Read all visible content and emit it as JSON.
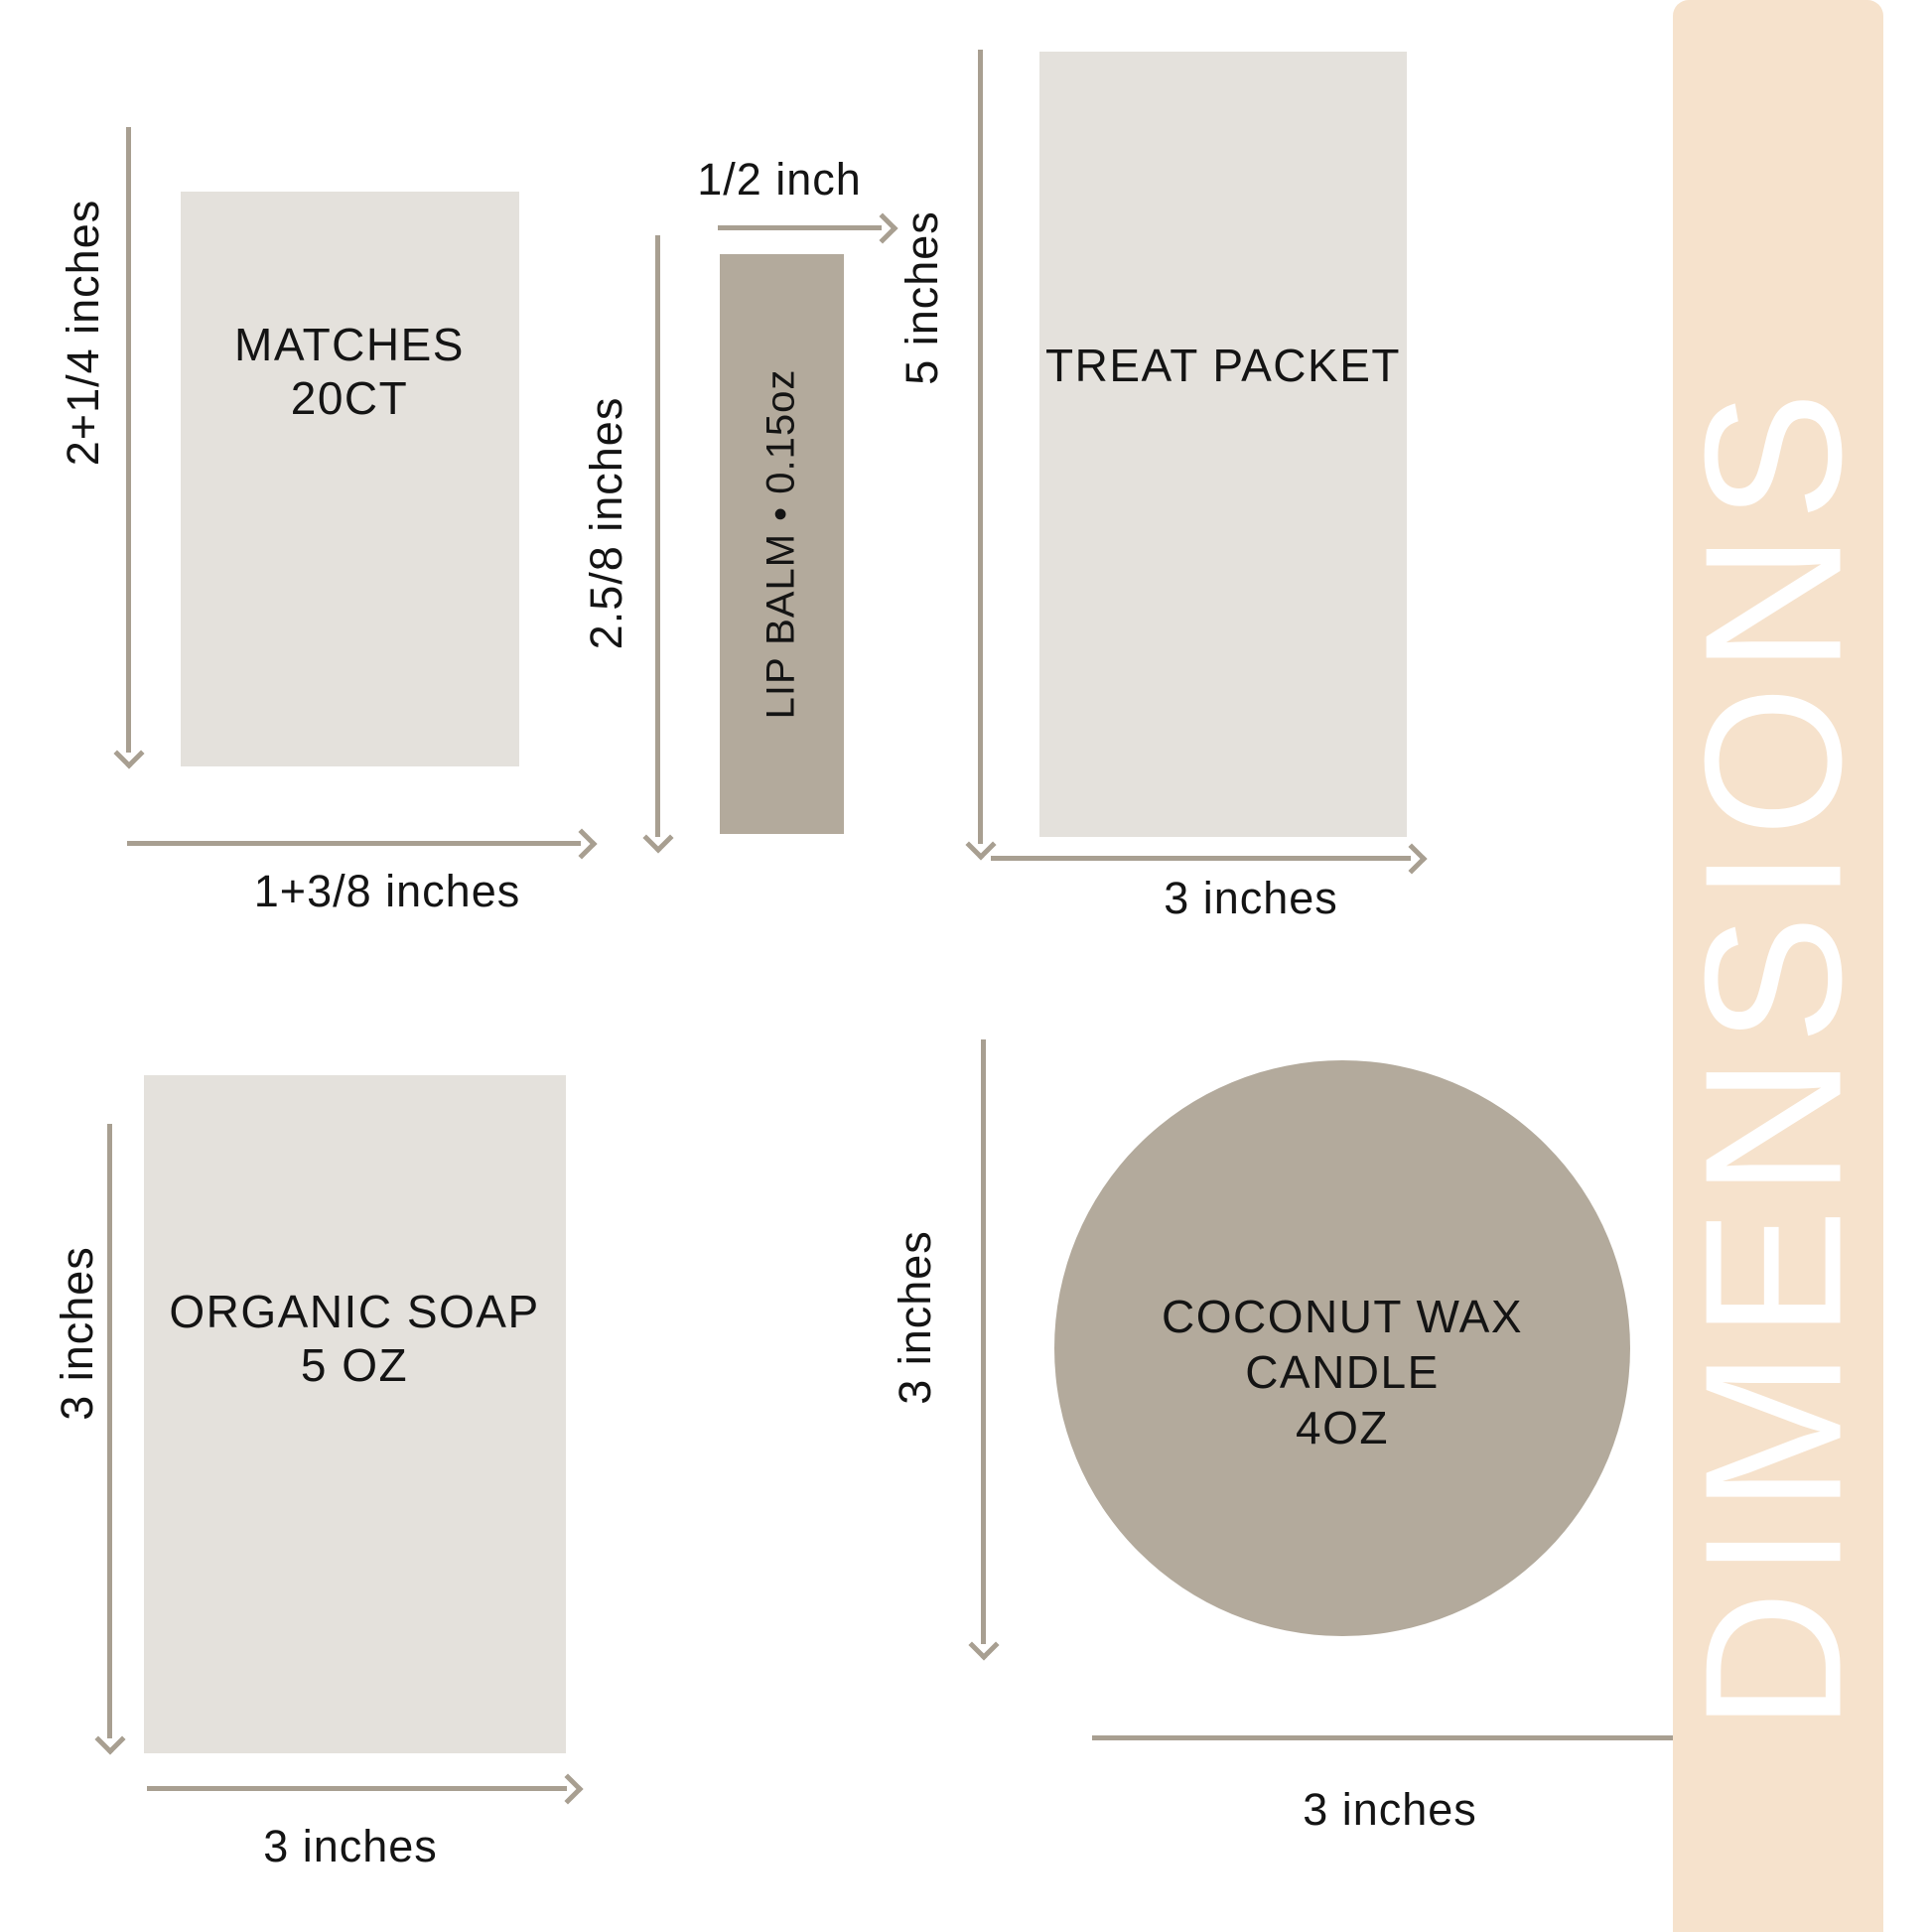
{
  "colors": {
    "box_gray": "#e4e1dc",
    "taupe": "#b3aa9c",
    "line": "#a89f91",
    "text": "#141414",
    "banner_bg": "#f6e2cc",
    "banner_text": "#ffffff"
  },
  "banner": {
    "label": "DIMENSIONS"
  },
  "items": {
    "matches": {
      "label_line1": "MATCHES",
      "label_line2": "20CT",
      "height_label": "2+1/4 inches",
      "width_label": "1+3/8 inches"
    },
    "lip_balm": {
      "label": "LIP BALM • 0.15oz",
      "width_label": "1/2 inch",
      "height_label": "2.5/8 inches"
    },
    "treat_packet": {
      "label": "TREAT PACKET",
      "height_label": "5 inches",
      "width_label": "3 inches"
    },
    "organic_soap": {
      "label_line1": "ORGANIC SOAP",
      "label_line2": "5 OZ",
      "height_label": "3 inches",
      "width_label": "3 inches"
    },
    "candle": {
      "label_line1": "COCONUT WAX",
      "label_line2": "CANDLE",
      "label_line3": "4OZ",
      "height_label": "3 inches",
      "width_label": "3 inches"
    }
  }
}
